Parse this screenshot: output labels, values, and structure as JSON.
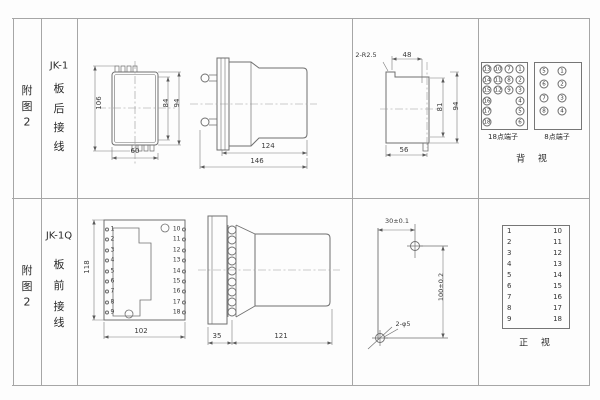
{
  "rows": [
    {
      "figure_chars": [
        "附",
        "图",
        "2"
      ],
      "model": "JK-1",
      "wiring_chars": [
        "板",
        "后",
        "接",
        "线"
      ],
      "rear_view": {
        "dim_height_overall": "106",
        "dim_height_case": "84",
        "dim_height_flange": "94",
        "dim_width": "60"
      },
      "side_view": {
        "dim_body": "124",
        "dim_overall": "146"
      },
      "panel_cutout": {
        "note_radius": "2-R2.5",
        "dim_top_width": "48",
        "dim_height_inner": "81",
        "dim_height_outer": "94",
        "dim_bottom_width": "56"
      },
      "block18": {
        "caption": "18点端子",
        "grid": [
          [
            "13",
            "10",
            "7",
            "1"
          ],
          [
            "14",
            "11",
            "8",
            "2"
          ],
          [
            "15",
            "12",
            "9",
            "3"
          ],
          [
            "16",
            "4"
          ],
          [
            "17",
            "5"
          ],
          [
            "18",
            "6"
          ]
        ]
      },
      "block8": {
        "caption": "8点端子",
        "grid": [
          [
            "5",
            "1"
          ],
          [
            "6",
            "2"
          ],
          [
            "7",
            "3"
          ],
          [
            "8",
            "4"
          ]
        ]
      },
      "view_caption": "背 视"
    },
    {
      "figure_chars": [
        "附",
        "图",
        "2"
      ],
      "model": "JK-1Q",
      "wiring_chars": [
        "板",
        "前",
        "接",
        "线"
      ],
      "front_view": {
        "dim_height": "118",
        "dim_width": "102",
        "left_terminals": [
          "1",
          "2",
          "3",
          "4",
          "5",
          "6",
          "7",
          "8",
          "9"
        ],
        "right_terminals": [
          "10",
          "11",
          "12",
          "13",
          "14",
          "15",
          "16",
          "17",
          "18"
        ]
      },
      "side_view": {
        "dim_plate": "35",
        "dim_body": "121"
      },
      "drill_template": {
        "dim_horizontal": "30±0.1",
        "dim_vertical": "100±0.2",
        "note_holes": "2-φ5"
      },
      "terminal_table": {
        "left": [
          "1",
          "2",
          "3",
          "4",
          "5",
          "6",
          "7",
          "8",
          "9"
        ],
        "right": [
          "10",
          "11",
          "12",
          "13",
          "14",
          "15",
          "16",
          "17",
          "18"
        ]
      },
      "view_caption": "正 视"
    }
  ]
}
